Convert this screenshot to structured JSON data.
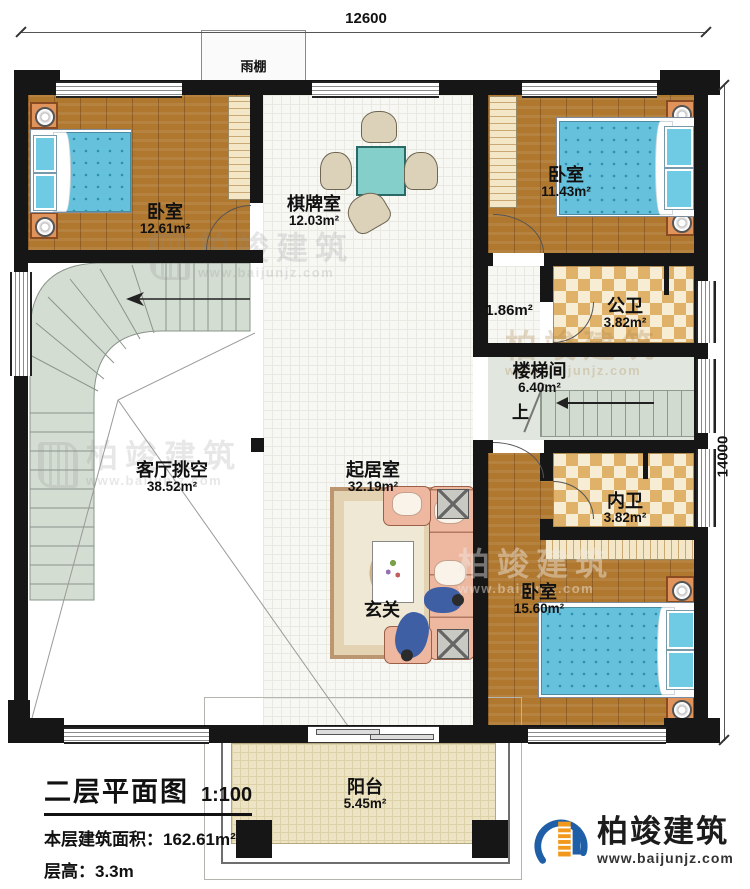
{
  "plan": {
    "title": "二层平面图",
    "scale": "1:100",
    "floor_area_label": "本层建筑面积：",
    "floor_area_value": "162.61m²",
    "floor_height": "层高：3.3m",
    "dim_top": "12600",
    "dim_right": "14000",
    "canopy": "雨棚",
    "up_label": "上"
  },
  "rooms": {
    "bedroom_tl": {
      "name": "卧室",
      "area": "12.61m²"
    },
    "game_room": {
      "name": "棋牌室",
      "area": "12.03m²"
    },
    "bedroom_tr": {
      "name": "卧室",
      "area": "11.43m²"
    },
    "hall": {
      "area": "1.86m²"
    },
    "public_bath": {
      "name": "公卫",
      "area": "3.82m²"
    },
    "stairwell": {
      "name": "楼梯间",
      "area": "6.40m²"
    },
    "void": {
      "name": "客厅挑空",
      "area": "38.52m²"
    },
    "living": {
      "name": "起居室",
      "area": "32.19m²"
    },
    "inner_bath": {
      "name": "内卫",
      "area": "3.82m²"
    },
    "bedroom_b": {
      "name": "卧室",
      "area": "15.60m²"
    },
    "foyer": {
      "name": "玄关"
    },
    "balcony": {
      "name": "阳台",
      "area": "5.45m²"
    }
  },
  "branding": {
    "name": "柏竣建筑",
    "url": "www.baijunjz.com"
  },
  "colors": {
    "wall": "#161616",
    "wood": "#b0772f",
    "tile": "#f7f7f4",
    "checker": "#dfb169",
    "stair": "#d2dbd0",
    "bed": "#66c1dc",
    "sofa": "#eeb79f",
    "logo_blue": "#1e5fa8",
    "logo_orange": "#f2991d"
  }
}
